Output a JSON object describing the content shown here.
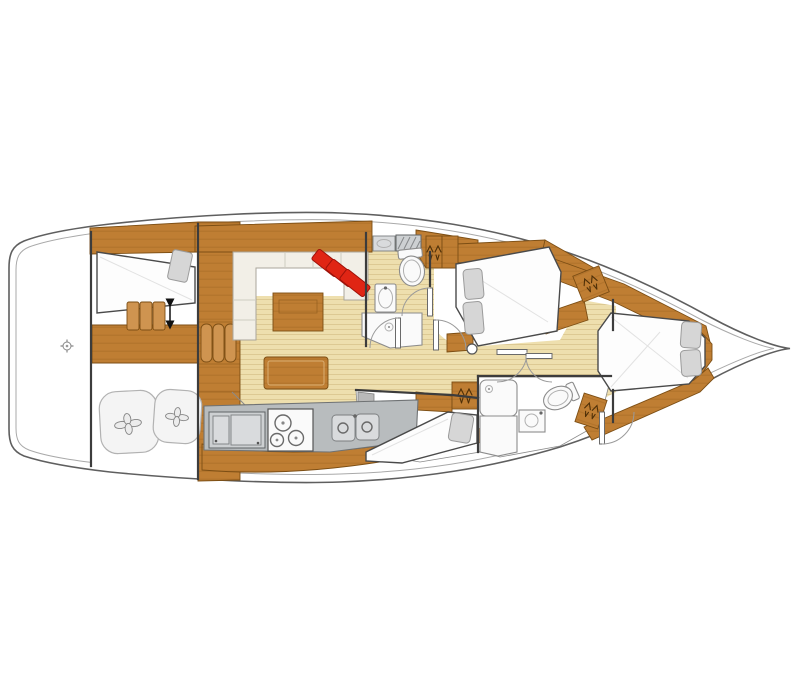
{
  "canvas": {
    "width": 800,
    "height": 700
  },
  "image": {
    "kind": "sailboat-interior-deck-plan",
    "bow_direction": "right",
    "stern_direction": "left",
    "visible_text": ""
  },
  "colors": {
    "background": "#ffffff",
    "hull_outline": "#5f5f5f",
    "deck_line": "#a9a9a9",
    "wall": "#3c3c3c",
    "wood": "#bf7e33",
    "wood_dark": "#7c4e14",
    "wood_light": "#cf9450",
    "wood_grain": "#a16522",
    "floor": "#eedfae",
    "floor_line": "#ddc993",
    "counter": "#b8bcbe",
    "counter_dark": "#6f7274",
    "fixture_fill": "#fafafa",
    "fixture_stroke": "#8c8c8c",
    "cushion": "#d6d6d6",
    "cushion_stroke": "#9b9b9b",
    "settee": "#f2efe7",
    "red": "#e02514",
    "red_dark": "#9e120a"
  },
  "areas": [
    {
      "name": "aft-cabin-port",
      "features": [
        "berth",
        "pillow",
        "companionway-steps",
        "up-down-arrow"
      ]
    },
    {
      "name": "aft-storage",
      "features": [
        "pouf",
        "pouf"
      ]
    },
    {
      "name": "salon",
      "features": [
        "u-settee",
        "fold-module",
        "dining-table",
        "red-cushions"
      ]
    },
    {
      "name": "galley",
      "features": [
        "refrigerator",
        "stove-3-burner",
        "double-sink",
        "counter"
      ]
    },
    {
      "name": "aft-head",
      "features": [
        "vanity",
        "toilet",
        "washbasin",
        "shower",
        "hanging-locker"
      ]
    },
    {
      "name": "port-cabin",
      "features": [
        "double-berth",
        "pillow",
        "pillow"
      ]
    },
    {
      "name": "starboard-cabin",
      "features": [
        "double-berth",
        "pillow"
      ]
    },
    {
      "name": "forward-head",
      "features": [
        "shower",
        "washbasin",
        "toilet",
        "hanging-locker"
      ]
    },
    {
      "name": "owner-cabin-bow",
      "features": [
        "v-berth",
        "pillow",
        "pillow",
        "hanging-locker",
        "hanging-locker"
      ]
    },
    {
      "name": "stern-deck",
      "features": [
        "cleat-icon"
      ]
    }
  ]
}
